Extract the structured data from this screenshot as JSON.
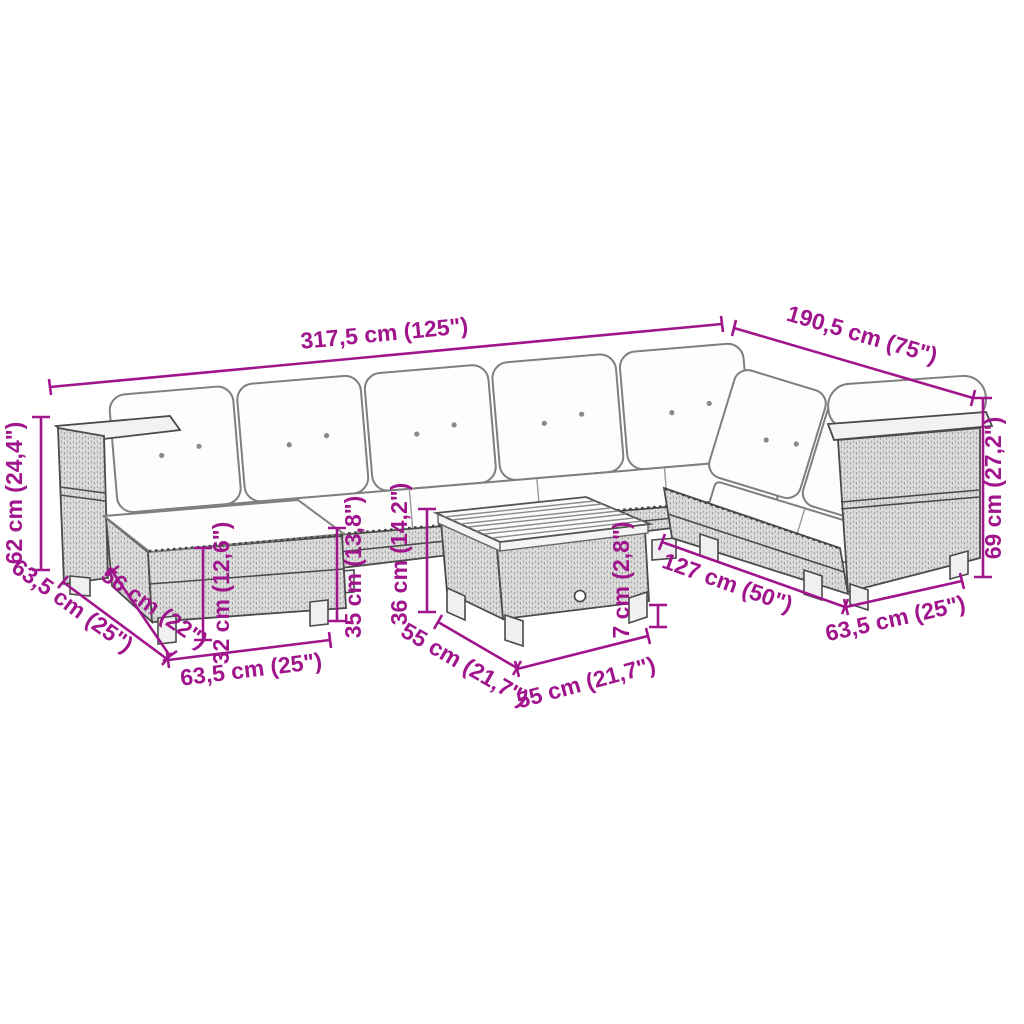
{
  "colors": {
    "dimension_accent": "#A0148C",
    "line_art": "#4a4a4a",
    "rattan_fill": "#dddddd",
    "cushion_fill": "#fdfdfc"
  },
  "dimensions": {
    "total_width": "317,5 cm (125\")",
    "total_depth_right": "190,5 cm (75\")",
    "right_arm_height": "69 cm (27,2\")",
    "left_arm_height": "62 cm (24,4\")",
    "left_module_depth": "63,5 cm (25\")",
    "ottoman_depth": "56 cm (22\")",
    "ottoman_height": "32 cm (12,6\")",
    "ottoman_width": "63,5 cm (25\")",
    "seat_height": "35 cm (13,8\")",
    "table_height": "36 cm (14,2\")",
    "table_depth": "55 cm (21,7\")",
    "table_width": "55 cm (21,7\")",
    "tabletop_thickness": "7 cm (2,8\")",
    "right_section_length": "127 cm (50\")",
    "right_module_depth": "63,5 cm (25\")"
  }
}
